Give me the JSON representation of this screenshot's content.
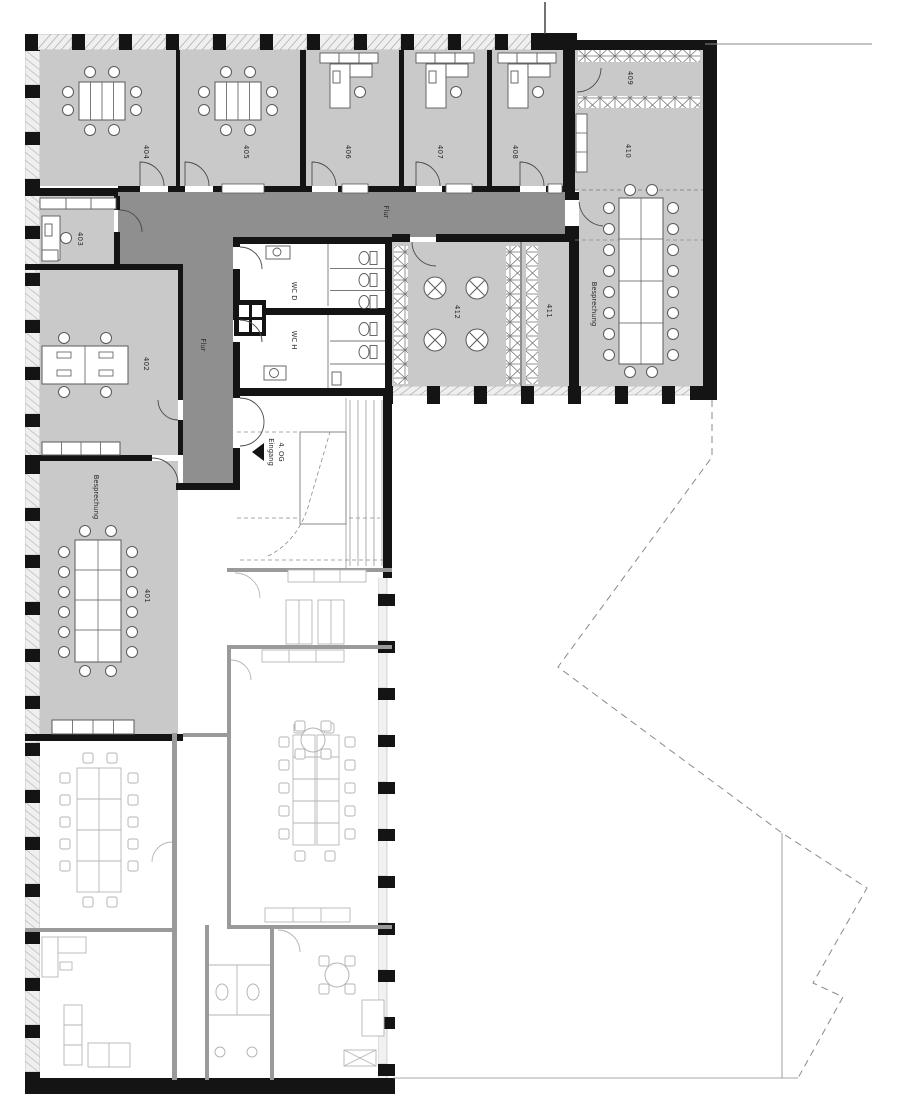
{
  "plan": {
    "type": "architectural-floor-plan",
    "floor_entrance": {
      "floor": "4. OG",
      "entrance": "Eingang"
    },
    "corridor": {
      "label_top": "Flur",
      "label_left": "Flur"
    },
    "wc": {
      "women": "WC D",
      "men": "WC H"
    },
    "rooms": [
      {
        "number": "401",
        "name": "Besprechung"
      },
      {
        "number": "402"
      },
      {
        "number": "403"
      },
      {
        "number": "404"
      },
      {
        "number": "405"
      },
      {
        "number": "406"
      },
      {
        "number": "407"
      },
      {
        "number": "408"
      },
      {
        "number": "409"
      },
      {
        "number": "410",
        "name": "Besprechung"
      },
      {
        "number": "411"
      },
      {
        "number": "412"
      }
    ],
    "colors": {
      "room_fill": "#c9c9c9",
      "corridor_fill": "#8f8f8f",
      "wall": "#141414",
      "hatch_band": "#efefef",
      "outline_stroke": "#b5b5b5",
      "furniture_stroke": "#5a5a5a",
      "label_color": "#2a2a2a",
      "background": "#ffffff"
    }
  }
}
